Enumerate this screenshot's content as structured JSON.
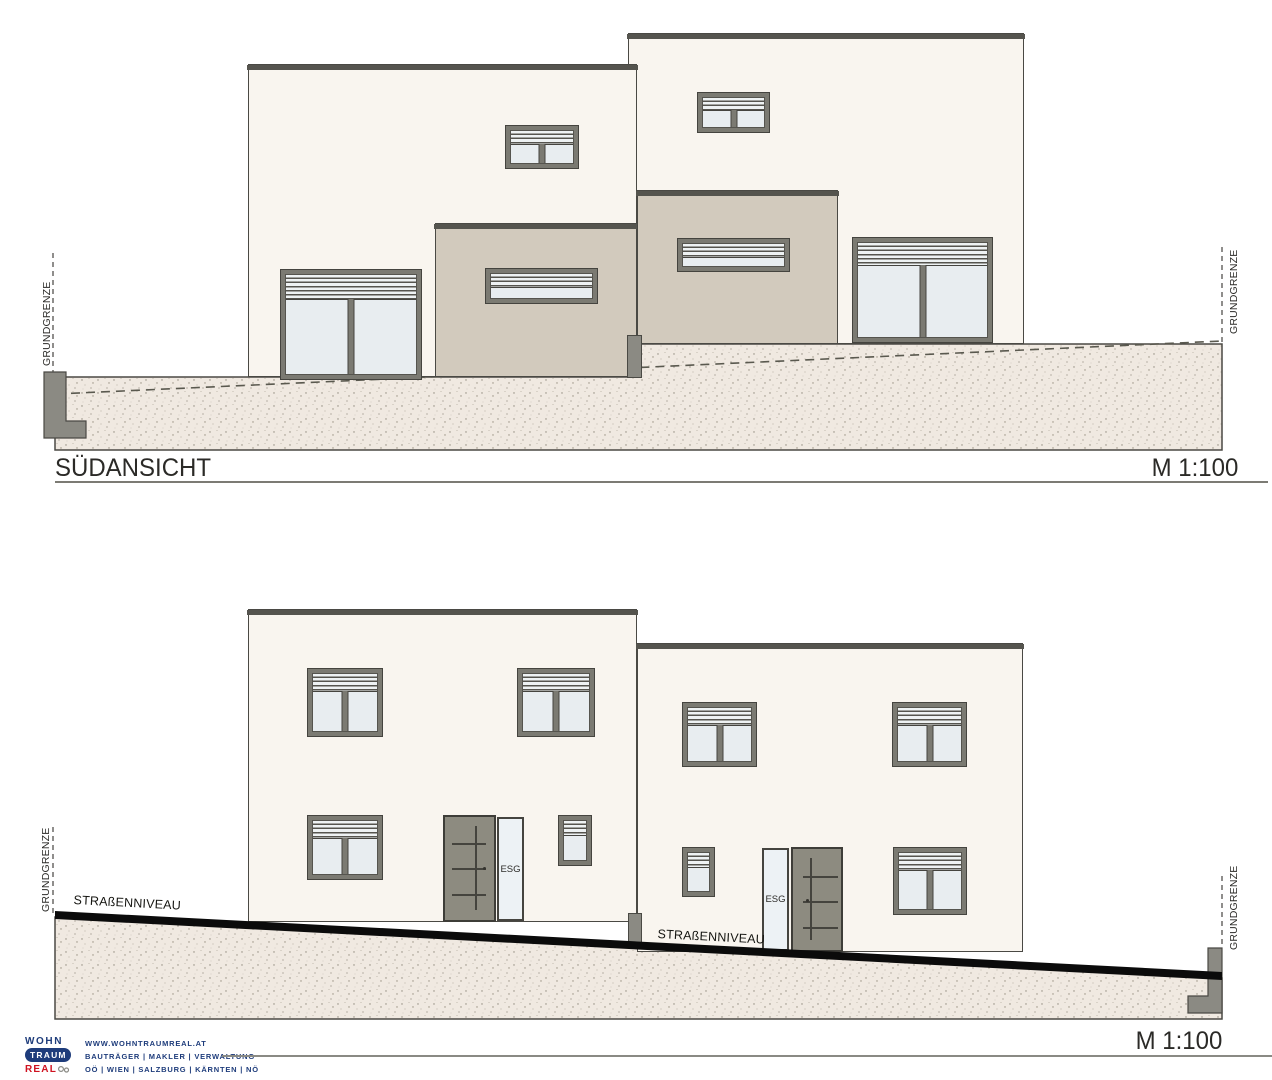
{
  "top_view": {
    "title": "SÜDANSICHT",
    "scale": "M 1:100",
    "labels": {
      "grundgrenze_left": "GRUNDGRENZE",
      "grundgrenze_right": "GRUNDGRENZE"
    }
  },
  "bottom_view": {
    "scale": "M 1:100",
    "labels": {
      "grundgrenze_left": "GRUNDGRENZE",
      "grundgrenze_right": "GRUNDGRENZE",
      "street_left": "STRAßENNIVEAU",
      "street_right": "STRAßENNIVEAU",
      "door_glass_left": "ESG",
      "door_glass_right": "ESG"
    }
  },
  "footer": {
    "logo": {
      "word1": "WOHN",
      "word2": "TRAUM",
      "word3": "REAL"
    },
    "website": "WWW.WOHNTRAUMREAL.AT",
    "services": "BAUTRÄGER | MAKLER | VERWALTUNG",
    "regions": "OÖ | WIEN | SALZBURG | KÄRNTEN | NÖ"
  },
  "colors": {
    "facade": "#f9f5ef",
    "annex": "#d2cabd",
    "terrain": "#f0e9e1",
    "window_frame": "#7b7a72",
    "glass": "#e8edf0",
    "door": "#8d8b80",
    "street": "#0b0b0b",
    "outline": "#4a4944",
    "logo_navy": "#1e3c7b",
    "logo_red": "#cf1220"
  }
}
